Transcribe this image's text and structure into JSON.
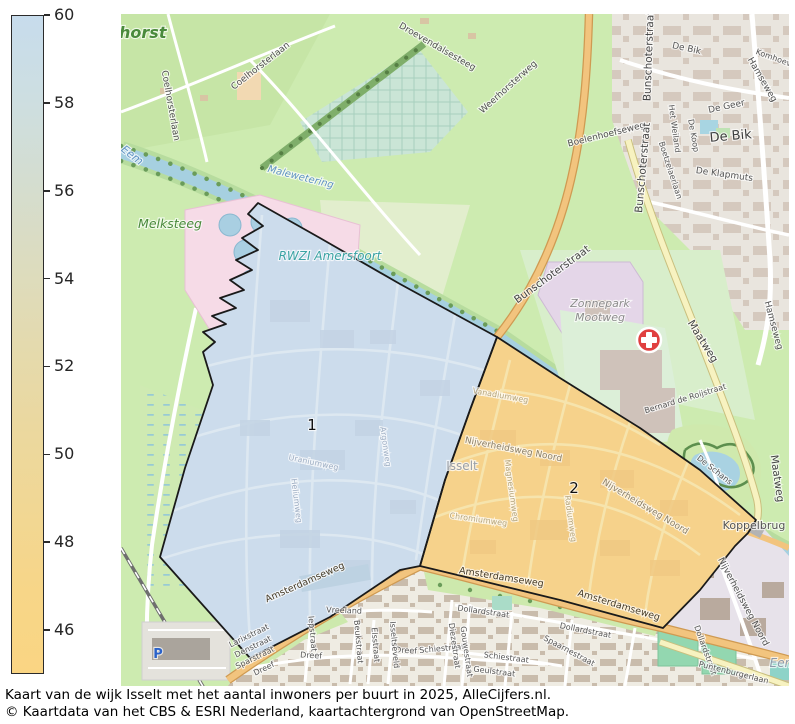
{
  "caption": {
    "line1": "Kaart van de wijk Isselt met het aantal inwoners per buurt in 2025, AlleCijfers.nl.",
    "line2": "© Kaartdata van het CBS & ESRI Nederland, kaartachtergrond van OpenStreetMap."
  },
  "colorbar": {
    "min": 45,
    "max": 60,
    "ticks": [
      60,
      58,
      56,
      54,
      52,
      50,
      48,
      46
    ],
    "gradient": [
      "#c7dcec",
      "#cddee1",
      "#d4ddd0",
      "#dcdcbf",
      "#e4daae",
      "#ebd89f",
      "#f1d794",
      "#f7d688",
      "#fad583"
    ]
  },
  "map": {
    "regions": [
      {
        "label": "1",
        "fill": "#ccdcec"
      },
      {
        "label": "2",
        "fill": "#f6d28b"
      }
    ],
    "theme": {
      "grass": "#cdebb0",
      "water": "#aad3df",
      "road_orange": "#f2c47e",
      "road_yellow": "#f7f2c0",
      "urban": "#e9e5de",
      "solar_park": "#e4d6e8",
      "rwzi_pink": "#f6dbe7",
      "hospital_red": "#e04040",
      "border": "#1a1a1a"
    },
    "labels": [
      {
        "t": "lhorst",
        "x": 140,
        "y": 38,
        "r": 0,
        "cl": "place-lg"
      },
      {
        "t": "Melksteeg",
        "x": 170,
        "y": 228,
        "r": 0,
        "cl": "place-md"
      },
      {
        "t": "Eem",
        "x": 130,
        "y": 158,
        "r": 38,
        "cl": "water-md"
      },
      {
        "t": "Malewetering",
        "x": 300,
        "y": 180,
        "r": 14,
        "cl": "water-sm"
      },
      {
        "t": "RWZI Amersfoort",
        "x": 330,
        "y": 260,
        "r": 0,
        "cl": "rwzi"
      },
      {
        "t": "Zonnepark",
        "x": 600,
        "y": 307,
        "r": 0,
        "cl": "area-gray"
      },
      {
        "t": "Mootweg",
        "x": 600,
        "y": 321,
        "r": 0,
        "cl": "area-gray"
      },
      {
        "t": "Isselt",
        "x": 462,
        "y": 470,
        "r": 0,
        "cl": "area-faded"
      },
      {
        "t": "Eem",
        "x": 783,
        "y": 667,
        "r": 0,
        "cl": "water-gray"
      },
      {
        "t": "Koppelbrug",
        "x": 754,
        "y": 529,
        "r": 0,
        "cl": "place-dark"
      },
      {
        "t": "De Bik",
        "x": 731,
        "y": 140,
        "r": -5,
        "cl": "hood-lg"
      },
      {
        "t": "De Bik",
        "x": 686,
        "y": 51,
        "r": 12,
        "cl": "hood-sm"
      },
      {
        "t": "De Geer",
        "x": 727,
        "y": 109,
        "r": -12,
        "cl": "hood-sm"
      },
      {
        "t": "De Klapmuts",
        "x": 724,
        "y": 177,
        "r": 8,
        "cl": "hood-sm"
      },
      {
        "t": "1",
        "x": 312,
        "y": 430,
        "r": 0,
        "cl": "region-num"
      },
      {
        "t": "2",
        "x": 574,
        "y": 493,
        "r": 0,
        "cl": "region-num"
      },
      {
        "t": "Coelhorsterlaan",
        "x": 262,
        "y": 68,
        "r": -38,
        "cl": "road"
      },
      {
        "t": "Coelhorsterlaan",
        "x": 168,
        "y": 106,
        "r": 80,
        "cl": "road"
      },
      {
        "t": "Droevendalsesteeg",
        "x": 436,
        "y": 49,
        "r": 30,
        "cl": "road"
      },
      {
        "t": "Weerhorsterweg",
        "x": 510,
        "y": 89,
        "r": -42,
        "cl": "road"
      },
      {
        "t": "Boelenhoefseweg",
        "x": 607,
        "y": 137,
        "r": -14,
        "cl": "road"
      },
      {
        "t": "Bunschoterstraat",
        "x": 652,
        "y": 56,
        "r": -88,
        "cl": "road-main"
      },
      {
        "t": "Bunschoterstraat",
        "x": 646,
        "y": 168,
        "r": -85,
        "cl": "road-main"
      },
      {
        "t": "Bunschoterstraat",
        "x": 554,
        "y": 277,
        "r": -36,
        "cl": "road-main"
      },
      {
        "t": "Hamseweg",
        "x": 760,
        "y": 81,
        "r": 60,
        "cl": "road"
      },
      {
        "t": "Komhoeve",
        "x": 775,
        "y": 61,
        "r": 20,
        "cl": "road-sm"
      },
      {
        "t": "De Koop",
        "x": 691,
        "y": 136,
        "r": 80,
        "cl": "road-sm"
      },
      {
        "t": "Het Weiland",
        "x": 672,
        "y": 129,
        "r": 82,
        "cl": "road-sm"
      },
      {
        "t": "Boetzelaerlaan",
        "x": 668,
        "y": 171,
        "r": 72,
        "cl": "road-sm"
      },
      {
        "t": "Hamseweg",
        "x": 771,
        "y": 326,
        "r": 75,
        "cl": "road"
      },
      {
        "t": "Maatweg",
        "x": 700,
        "y": 343,
        "r": 58,
        "cl": "road-main"
      },
      {
        "t": "Maatweg",
        "x": 774,
        "y": 479,
        "r": 82,
        "cl": "road-main"
      },
      {
        "t": "Bernard de Roijstraat",
        "x": 686,
        "y": 401,
        "r": -17,
        "cl": "road-sm"
      },
      {
        "t": "De Schans",
        "x": 713,
        "y": 472,
        "r": 38,
        "cl": "road-sm"
      },
      {
        "t": "Nijverheidsweg Noord",
        "x": 513,
        "y": 452,
        "r": 11,
        "cl": "road-ind"
      },
      {
        "t": "Nijverheidsweg Noord",
        "x": 644,
        "y": 509,
        "r": 31,
        "cl": "road-ind"
      },
      {
        "t": "Nijverheidsweg Noord",
        "x": 741,
        "y": 603,
        "r": 62,
        "cl": "road"
      },
      {
        "t": "Vanadiumweg",
        "x": 500,
        "y": 398,
        "r": 10,
        "cl": "road-ind-faint"
      },
      {
        "t": "Chromiumweg",
        "x": 478,
        "y": 522,
        "r": 8,
        "cl": "road-ind-faint"
      },
      {
        "t": "Magnesiumweg",
        "x": 509,
        "y": 491,
        "r": 82,
        "cl": "road-ind-faint"
      },
      {
        "t": "Radiumweg",
        "x": 568,
        "y": 519,
        "r": 82,
        "cl": "road-ind-faint"
      },
      {
        "t": "Uraniumweg",
        "x": 313,
        "y": 465,
        "r": 12,
        "cl": "road-blue-faint"
      },
      {
        "t": "Argonweg",
        "x": 383,
        "y": 447,
        "r": 82,
        "cl": "road-blue-faint"
      },
      {
        "t": "Heliumweg",
        "x": 294,
        "y": 501,
        "r": 83,
        "cl": "road-blue-faint"
      },
      {
        "t": "Amsterdamseweg",
        "x": 306,
        "y": 585,
        "r": -24,
        "cl": "road-on"
      },
      {
        "t": "Amsterdamseweg",
        "x": 501,
        "y": 580,
        "r": 9,
        "cl": "road-on"
      },
      {
        "t": "Amsterdamseweg",
        "x": 618,
        "y": 608,
        "r": 17,
        "cl": "road-on"
      },
      {
        "t": "Vreeland",
        "x": 344,
        "y": 613,
        "r": 2,
        "cl": "road-sm"
      },
      {
        "t": "Larixstraat",
        "x": 250,
        "y": 638,
        "r": -26,
        "cl": "road-sm"
      },
      {
        "t": "Denstraat",
        "x": 254,
        "y": 649,
        "r": -26,
        "cl": "road-sm"
      },
      {
        "t": "Sparstraat",
        "x": 256,
        "y": 660,
        "r": -26,
        "cl": "road-sm"
      },
      {
        "t": "Dreef",
        "x": 265,
        "y": 671,
        "r": -26,
        "cl": "road-sm"
      },
      {
        "t": "Dreef",
        "x": 311,
        "y": 658,
        "r": 3,
        "cl": "road-sm"
      },
      {
        "t": "Dreef",
        "x": 406,
        "y": 653,
        "r": 3,
        "cl": "road-sm"
      },
      {
        "t": "Iepstraat",
        "x": 310,
        "y": 634,
        "r": 85,
        "cl": "road-sm"
      },
      {
        "t": "Beukstraat",
        "x": 356,
        "y": 642,
        "r": 85,
        "cl": "road-sm"
      },
      {
        "t": "Elsstraat",
        "x": 373,
        "y": 645,
        "r": 85,
        "cl": "road-sm"
      },
      {
        "t": "Isseltseveld",
        "x": 392,
        "y": 645,
        "r": 85,
        "cl": "road-sm"
      },
      {
        "t": "Dollardstraat",
        "x": 483,
        "y": 614,
        "r": 8,
        "cl": "road-sm"
      },
      {
        "t": "Dollardstraat",
        "x": 585,
        "y": 633,
        "r": 11,
        "cl": "road-sm"
      },
      {
        "t": "Dollardstraat",
        "x": 703,
        "y": 651,
        "r": 70,
        "cl": "road-sm"
      },
      {
        "t": "Schiestraat",
        "x": 442,
        "y": 651,
        "r": -5,
        "cl": "road-sm"
      },
      {
        "t": "Schiestraat",
        "x": 506,
        "y": 660,
        "r": 7,
        "cl": "road-sm"
      },
      {
        "t": "Geulstraat",
        "x": 494,
        "y": 674,
        "r": 7,
        "cl": "road-sm"
      },
      {
        "t": "Spaarnestraat",
        "x": 568,
        "y": 653,
        "r": 28,
        "cl": "road-sm"
      },
      {
        "t": "Diezestraat",
        "x": 452,
        "y": 646,
        "r": 82,
        "cl": "road-sm"
      },
      {
        "t": "Gouwestraat",
        "x": 464,
        "y": 652,
        "r": 82,
        "cl": "road-sm"
      },
      {
        "t": "Puntenburgerlaan",
        "x": 733,
        "y": 675,
        "r": 14,
        "cl": "road-sm"
      },
      {
        "t": "P",
        "x": 158,
        "y": 658,
        "r": 0,
        "cl": "parking"
      }
    ]
  }
}
